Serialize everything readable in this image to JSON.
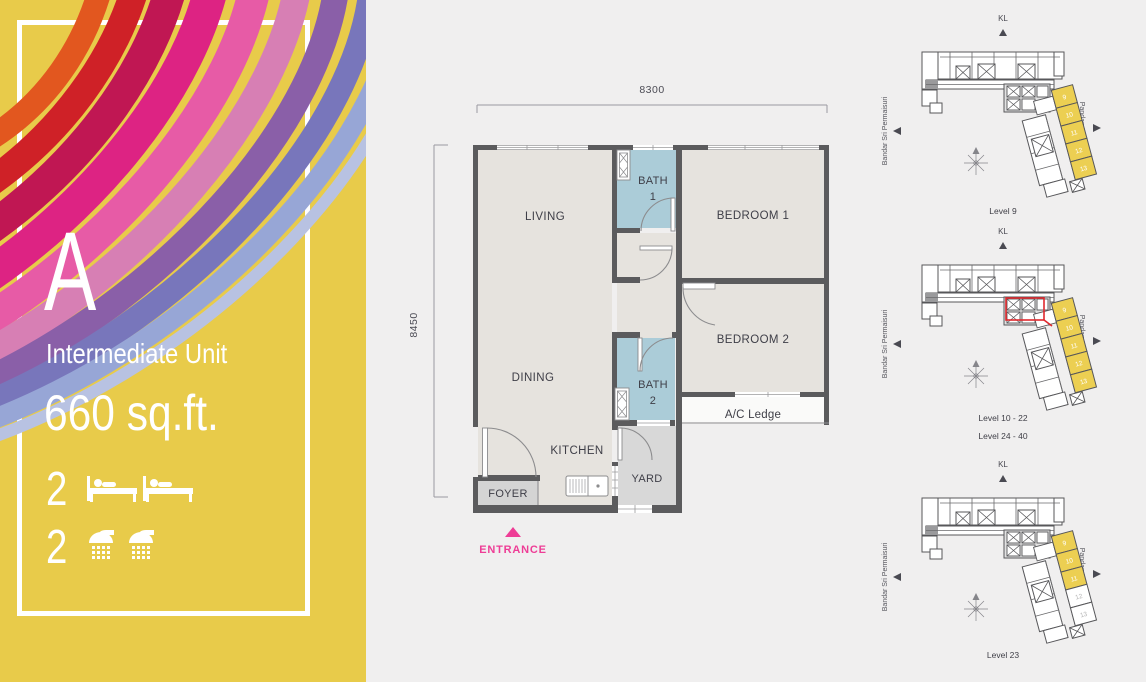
{
  "panel": {
    "letter": "A",
    "type_label": "Intermediate Unit",
    "area_label": "660 sq.ft.",
    "bed_count": "2",
    "bath_count": "2",
    "bg_color": "#e8cb4a"
  },
  "floorplan": {
    "width_dim": "8300",
    "height_dim": "8450",
    "living": "LIVING",
    "dining": "DINING",
    "kitchen": "KITCHEN",
    "foyer": "FOYER",
    "yard": "YARD",
    "bath1_l1": "BATH",
    "bath1_l2": "1",
    "bath2_l1": "BATH",
    "bath2_l2": "2",
    "bedroom1": "BEDROOM 1",
    "bedroom2": "BEDROOM 2",
    "ac_ledge": "A/C Ledge",
    "entrance": "ENTRANCE",
    "colors": {
      "wall": "#5b5b5d",
      "room": "#e6e3de",
      "bath": "#abccd8",
      "service": "#d8d8d8",
      "entrance_pink": "#ee3d96"
    }
  },
  "keyplans": [
    {
      "kl": "KL",
      "left_road": "Bandar Sri Permaisuri",
      "right_road": "Pandan Perdana",
      "captions": [
        "Level 9",
        ""
      ],
      "red_stroke": "none",
      "units": [
        {
          "n": "9",
          "fill": "#eccf52",
          "text_fill": "#ffffff"
        },
        {
          "n": "10",
          "fill": "#eccf52",
          "text_fill": "#ffffff"
        },
        {
          "n": "11",
          "fill": "#eccf52",
          "text_fill": "#ffffff"
        },
        {
          "n": "12",
          "fill": "#eccf52",
          "text_fill": "#ffffff"
        },
        {
          "n": "13",
          "fill": "#eccf52",
          "text_fill": "#ffffff"
        }
      ]
    },
    {
      "kl": "KL",
      "left_road": "Bandar Sri Permaisuri",
      "right_road": "Pandan Perdana",
      "captions": [
        "Level 10 - 22",
        "Level 24 - 40"
      ],
      "red_stroke": "#e0282d",
      "units": [
        {
          "n": "9",
          "fill": "#eccf52",
          "text_fill": "#ffffff"
        },
        {
          "n": "10",
          "fill": "#eccf52",
          "text_fill": "#ffffff"
        },
        {
          "n": "11",
          "fill": "#eccf52",
          "text_fill": "#ffffff"
        },
        {
          "n": "12",
          "fill": "#eccf52",
          "text_fill": "#ffffff"
        },
        {
          "n": "13",
          "fill": "#eccf52",
          "text_fill": "#ffffff"
        }
      ]
    },
    {
      "kl": "KL",
      "left_road": "Bandar Sri Permaisuri",
      "right_road": "Pandan Perdana",
      "captions": [
        "Level 23",
        ""
      ],
      "red_stroke": "none",
      "units": [
        {
          "n": "9",
          "fill": "#eccf52",
          "text_fill": "#ffffff"
        },
        {
          "n": "10",
          "fill": "#eccf52",
          "text_fill": "#ffffff"
        },
        {
          "n": "11",
          "fill": "#eccf52",
          "text_fill": "#ffffff"
        },
        {
          "n": "12",
          "fill": "#ffffff",
          "text_fill": "#b5b5b5"
        },
        {
          "n": "13",
          "fill": "#ffffff",
          "text_fill": "#b5b5b5"
        }
      ]
    }
  ]
}
